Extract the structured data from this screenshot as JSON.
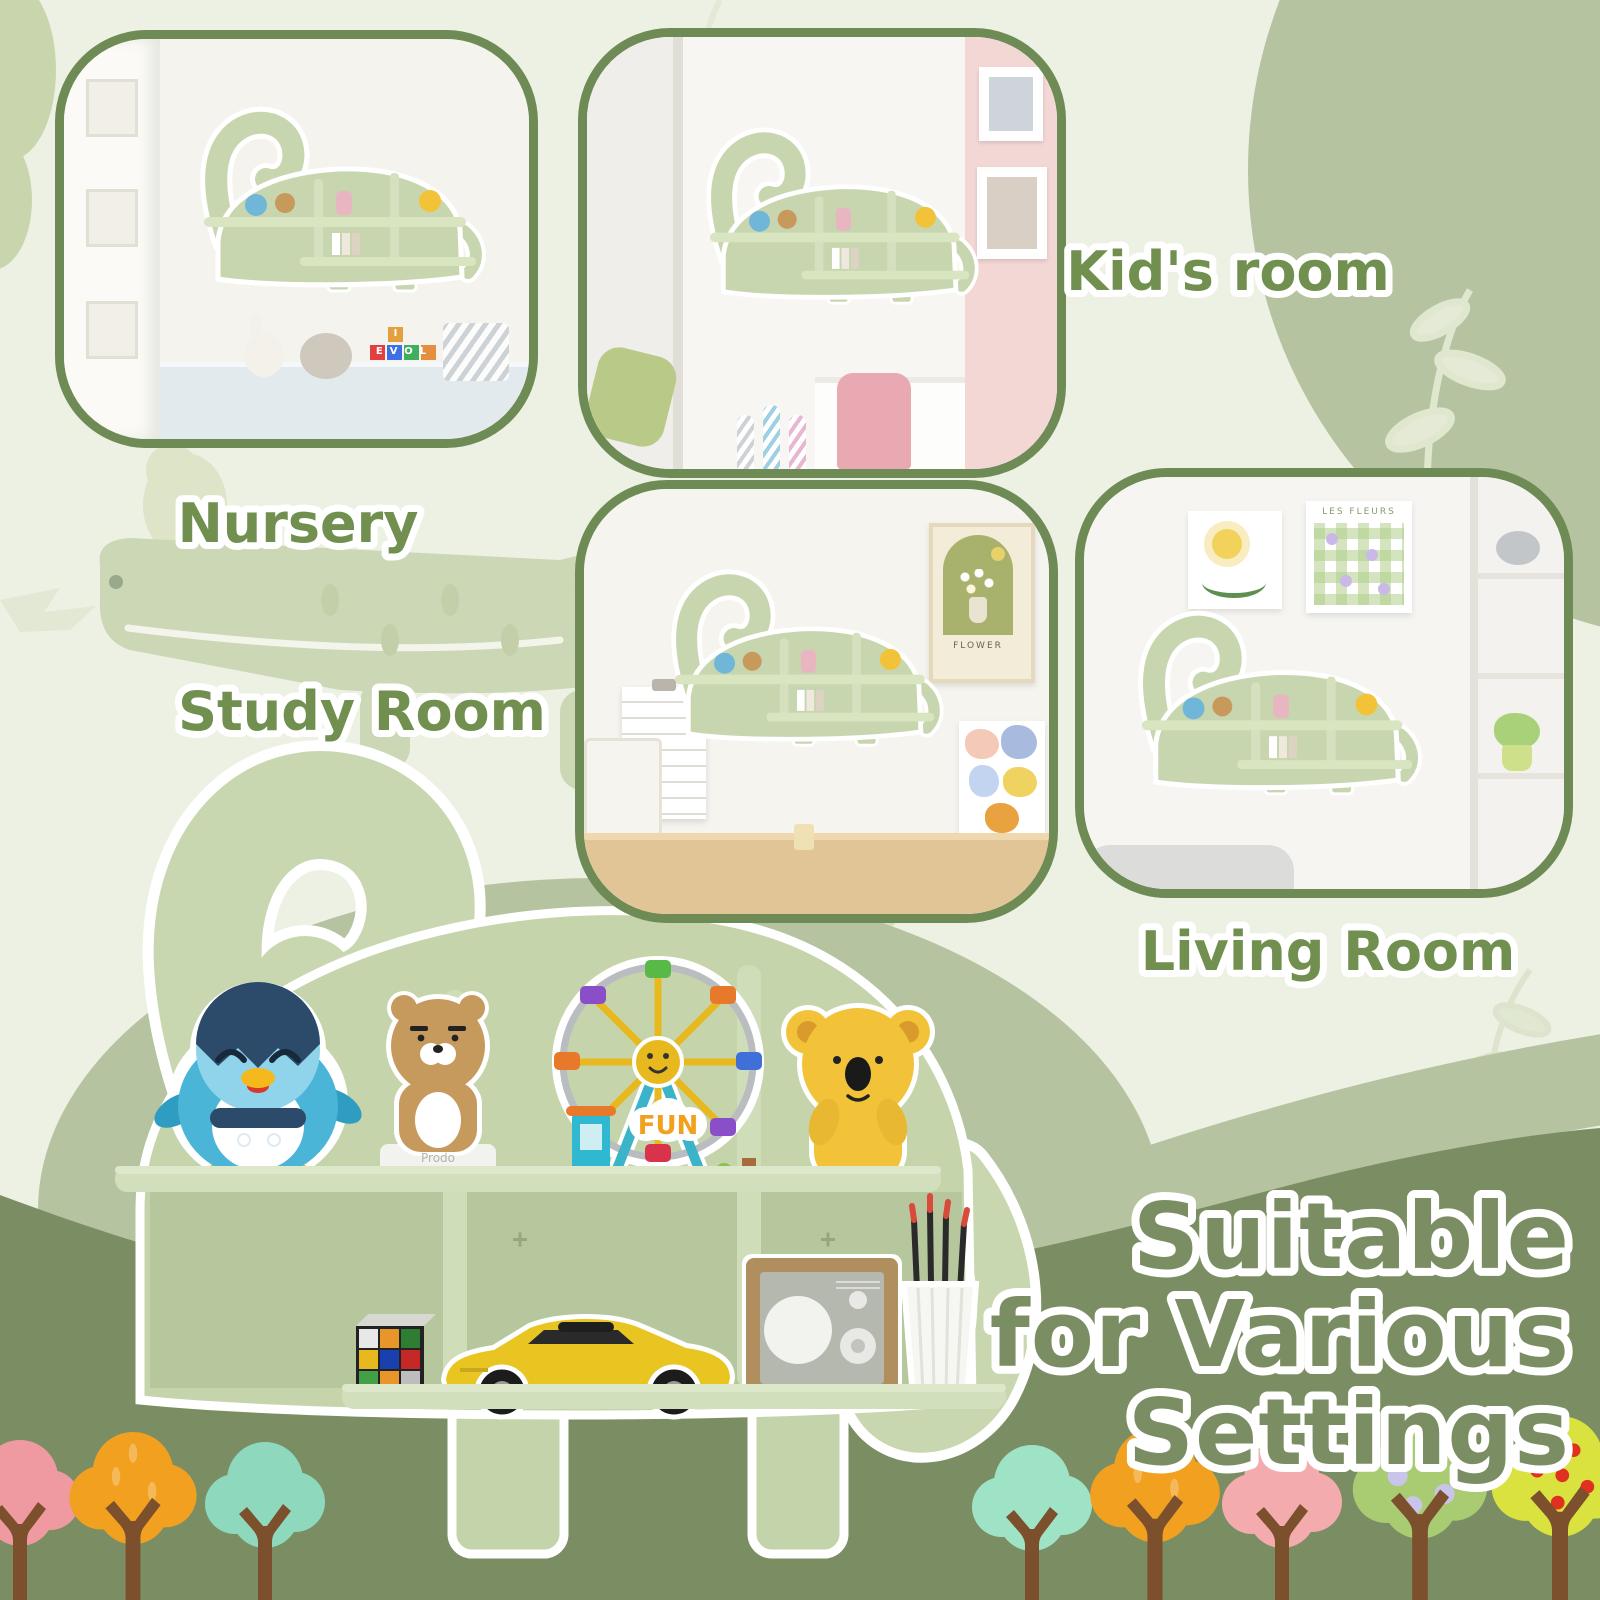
{
  "poster": {
    "headline": {
      "line1": "Suitable",
      "line2": "for Various",
      "line3": "Settings"
    },
    "labels": {
      "nursery": "Nursery",
      "kids_room": "Kid's room",
      "study_room": "Study Room",
      "living_room": "Living Room"
    },
    "product": {
      "fun_sign": "FUN",
      "figure_base_line1": "Prodo",
      "figure_base_line2": "KakaoFriends",
      "top_shelf_items": [
        "penguin figurine",
        "bear figurine",
        "LEGO ferris wheel",
        "koala figurine"
      ],
      "bottom_shelf_items": [
        "rubik's cube",
        "yellow toy sports car",
        "wooden radio",
        "pencil cup with pencils"
      ]
    },
    "photos": {
      "nursery": {
        "caption": "Nursery",
        "blocks_top_letter": "I",
        "blocks_text": "EVOL",
        "book_spine_texts": [
          "GREENLAND",
          "Graphic Design",
          "Architectural"
        ]
      },
      "kids_room": {
        "caption": "Kid's room"
      },
      "study_room": {
        "caption": "Study Room",
        "poster_text": "FLOWER"
      },
      "living_room": {
        "caption": "Living Room",
        "card_text": "LES FLEURS",
        "book_spine_texts": [
          "LUCIAN FREUD",
          "BAGUETTE",
          "MY RESIDENCE",
          "Voyage"
        ]
      }
    },
    "colors": {
      "page_bg": "#edf1e3",
      "sage": "#b5c3a0",
      "dark_green": "#7b8e63",
      "photo_border": "#6f8b55",
      "label_text": "#71904f",
      "dino_body": "#c5d4ab",
      "dino_board": "#d2dfbc",
      "outline": "#ffffff",
      "tree_colors": [
        "#ef9aa0",
        "#f2a01f",
        "#8ed9be",
        "#9fe3c6",
        "#f2a01f",
        "#f4abae",
        "#a9cb72",
        "#d9e23f"
      ]
    }
  }
}
